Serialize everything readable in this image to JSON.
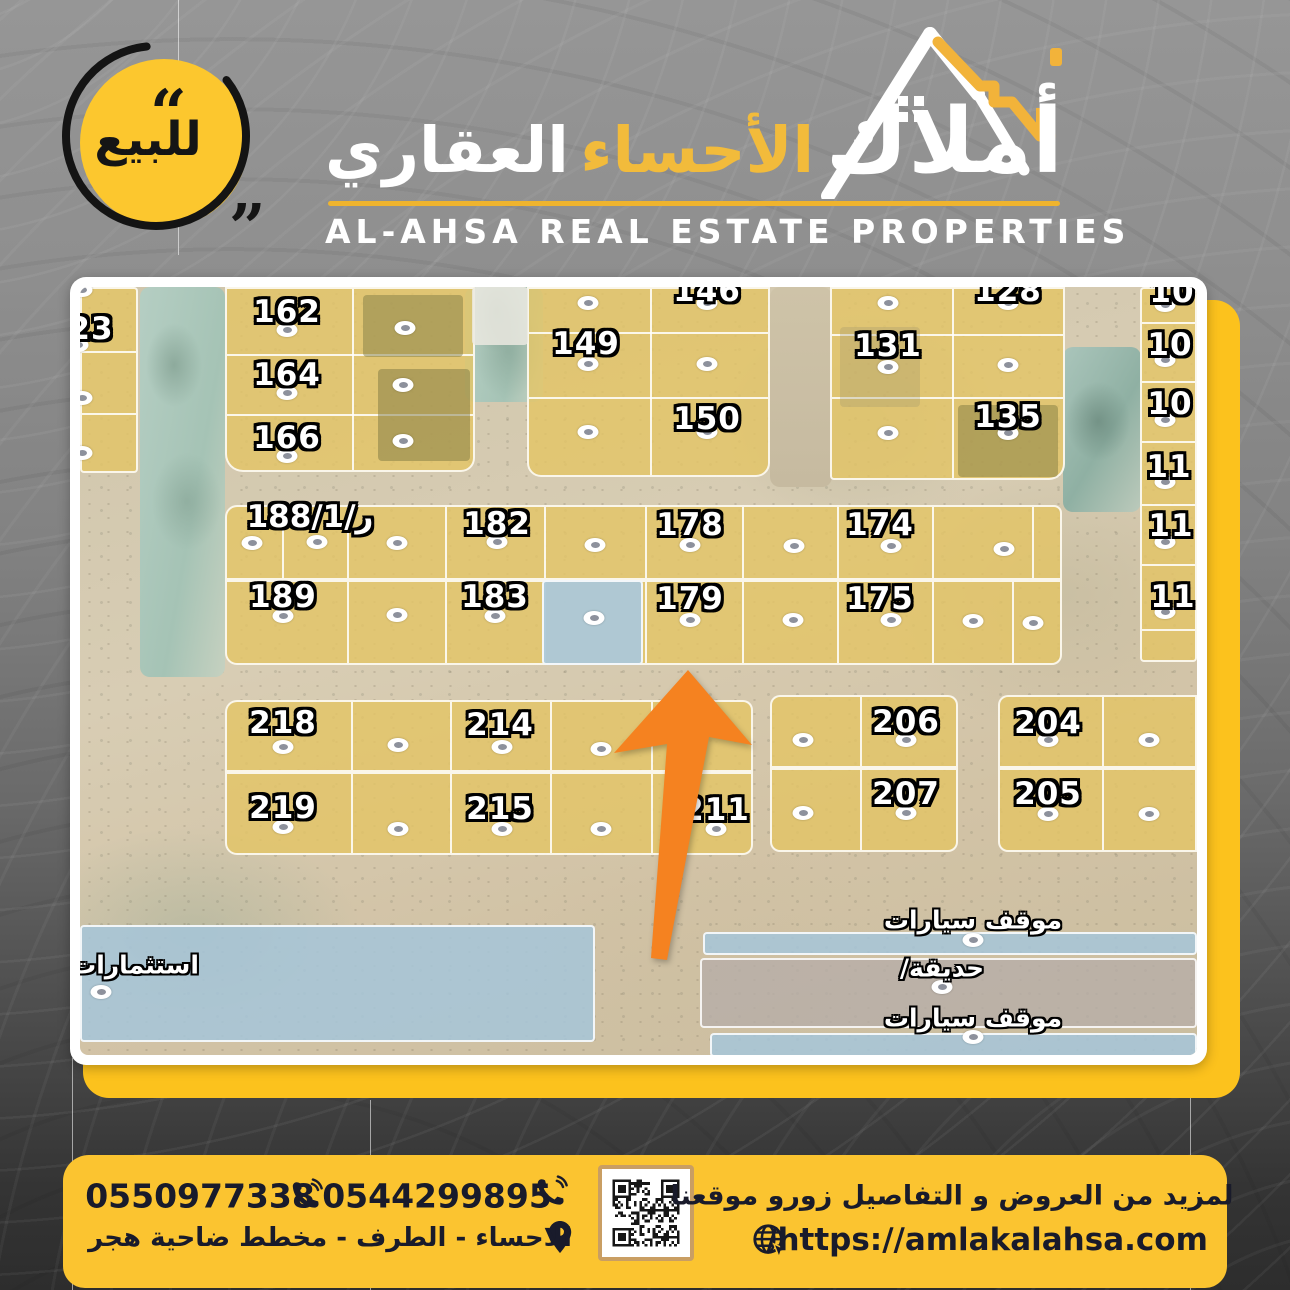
{
  "badge": {
    "label": "للبيع",
    "quote_open": "“",
    "quote_close": "„"
  },
  "logo": {
    "arabic_word_1": "أملاك",
    "arabic_word_2": "الأحساء",
    "arabic_word_3": "العقاري",
    "english": "AL-AHSA REAL ESTATE PROPERTIES"
  },
  "colors": {
    "accent_yellow": "#fcc21d",
    "footer_yellow": "#fbc430",
    "arrow_orange": "#f58220",
    "plot_yellow": "#e3c464",
    "water_blue": "#a6c6d9",
    "dark_text": "#191b2b"
  },
  "map": {
    "plots": [
      {
        "label": "23",
        "x": 11,
        "y": 42
      },
      {
        "label": "162",
        "x": 207,
        "y": 25
      },
      {
        "label": "164",
        "x": 207,
        "y": 88
      },
      {
        "label": "166",
        "x": 207,
        "y": 151
      },
      {
        "label": "146",
        "x": 627,
        "y": 4
      },
      {
        "label": "149",
        "x": 506,
        "y": 57
      },
      {
        "label": "150",
        "x": 627,
        "y": 132
      },
      {
        "label": "128",
        "x": 928,
        "y": 4
      },
      {
        "label": "131",
        "x": 808,
        "y": 59
      },
      {
        "label": "135",
        "x": 928,
        "y": 130
      },
      {
        "label": "10",
        "x": 1092,
        "y": 5
      },
      {
        "label": "10",
        "x": 1090,
        "y": 58
      },
      {
        "label": "10",
        "x": 1090,
        "y": 117
      },
      {
        "label": "11",
        "x": 1089,
        "y": 180
      },
      {
        "label": "11",
        "x": 1091,
        "y": 239
      },
      {
        "label": "11",
        "x": 1093,
        "y": 310
      },
      {
        "label": "ر/188/1",
        "x": 230,
        "y": 230
      },
      {
        "label": "182",
        "x": 417,
        "y": 237
      },
      {
        "label": "178",
        "x": 610,
        "y": 238
      },
      {
        "label": "174",
        "x": 800,
        "y": 238
      },
      {
        "label": "189",
        "x": 203,
        "y": 310
      },
      {
        "label": "183",
        "x": 415,
        "y": 310
      },
      {
        "label": "179",
        "x": 610,
        "y": 312
      },
      {
        "label": "175",
        "x": 800,
        "y": 312
      },
      {
        "label": "218",
        "x": 203,
        "y": 436
      },
      {
        "label": "214",
        "x": 420,
        "y": 438
      },
      {
        "label": "219",
        "x": 203,
        "y": 521
      },
      {
        "label": "215",
        "x": 420,
        "y": 522
      },
      {
        "label": "211",
        "x": 636,
        "y": 523
      },
      {
        "label": "206",
        "x": 826,
        "y": 435
      },
      {
        "label": "207",
        "x": 826,
        "y": 507
      },
      {
        "label": "204",
        "x": 968,
        "y": 436
      },
      {
        "label": "205",
        "x": 968,
        "y": 507
      }
    ],
    "area_labels": [
      {
        "label": "موقف سيارات",
        "x": 893,
        "y": 633
      },
      {
        "label": "حديقة/",
        "x": 862,
        "y": 681
      },
      {
        "label": "موقف سيارات",
        "x": 893,
        "y": 731
      },
      {
        "label": "استثمارات",
        "x": 55,
        "y": 678
      }
    ],
    "dots": [
      [
        2,
        3
      ],
      [
        -2,
        58
      ],
      [
        2,
        111
      ],
      [
        2,
        166
      ],
      [
        207,
        43
      ],
      [
        207,
        106
      ],
      [
        207,
        169
      ],
      [
        325,
        41
      ],
      [
        323,
        98
      ],
      [
        323,
        154
      ],
      [
        508,
        16
      ],
      [
        627,
        16
      ],
      [
        508,
        77
      ],
      [
        627,
        77
      ],
      [
        508,
        145
      ],
      [
        627,
        145
      ],
      [
        808,
        16
      ],
      [
        928,
        16
      ],
      [
        808,
        80
      ],
      [
        928,
        78
      ],
      [
        808,
        146
      ],
      [
        928,
        146
      ],
      [
        1085,
        18
      ],
      [
        1085,
        73
      ],
      [
        1085,
        133
      ],
      [
        1085,
        195
      ],
      [
        1085,
        255
      ],
      [
        1085,
        325
      ],
      [
        172,
        256
      ],
      [
        237,
        255
      ],
      [
        317,
        256
      ],
      [
        417,
        255
      ],
      [
        515,
        258
      ],
      [
        610,
        258
      ],
      [
        714,
        259
      ],
      [
        811,
        259
      ],
      [
        924,
        262
      ],
      [
        203,
        329
      ],
      [
        317,
        328
      ],
      [
        415,
        329
      ],
      [
        514,
        331
      ],
      [
        610,
        333
      ],
      [
        713,
        333
      ],
      [
        811,
        333
      ],
      [
        893,
        334
      ],
      [
        953,
        336
      ],
      [
        203,
        460
      ],
      [
        318,
        458
      ],
      [
        422,
        460
      ],
      [
        521,
        462
      ],
      [
        203,
        540
      ],
      [
        318,
        542
      ],
      [
        422,
        542
      ],
      [
        521,
        542
      ],
      [
        636,
        542
      ],
      [
        723,
        453
      ],
      [
        826,
        453
      ],
      [
        723,
        526
      ],
      [
        826,
        526
      ],
      [
        968,
        453
      ],
      [
        1069,
        453
      ],
      [
        968,
        527
      ],
      [
        1069,
        527
      ],
      [
        893,
        653
      ],
      [
        862,
        700
      ],
      [
        893,
        750
      ],
      [
        21,
        705
      ]
    ],
    "roads": [
      {
        "x": 60,
        "y": 0,
        "w": 85,
        "h": 390,
        "c": "teal"
      },
      {
        "x": 385,
        "y": 0,
        "w": 78,
        "h": 115,
        "c": "teal"
      },
      {
        "x": 983,
        "y": 60,
        "w": 78,
        "h": 165,
        "c": "teal2"
      },
      {
        "x": 690,
        "y": 0,
        "w": 62,
        "h": 200,
        "c": "sand2"
      }
    ],
    "blocks": [
      {
        "x": 0,
        "y": 0,
        "w": 58,
        "h": 186,
        "hd": [
          62,
          124
        ]
      },
      {
        "x": 145,
        "y": 0,
        "w": 250,
        "h": 185,
        "vd": [
          125
        ],
        "hd": [
          65,
          125
        ],
        "r": "0 0 14px 18px"
      },
      {
        "x": 447,
        "y": 0,
        "w": 243,
        "h": 190,
        "vd": [
          121
        ],
        "hd": [
          43,
          108
        ],
        "r": "0 0 14px 14px"
      },
      {
        "x": 750,
        "y": 0,
        "w": 235,
        "h": 193,
        "vd": [
          120
        ],
        "hd": [
          45,
          108
        ],
        "r": "0 0 16px 4px"
      },
      {
        "x": 1060,
        "y": 0,
        "w": 57,
        "h": 375,
        "hd": [
          33,
          92,
          152,
          215,
          275,
          340
        ]
      },
      {
        "x": 145,
        "y": 218,
        "w": 837,
        "h": 75,
        "vd": [
          55,
          120,
          218,
          317,
          418,
          515,
          610,
          705,
          805
        ],
        "r": "12px 8px 0 0"
      },
      {
        "x": 145,
        "y": 293,
        "w": 837,
        "h": 85,
        "vd": [
          120,
          218,
          317,
          418,
          515,
          610,
          705,
          785
        ],
        "r": "0 0 10px 12px"
      },
      {
        "x": 145,
        "y": 413,
        "w": 528,
        "h": 72,
        "vd": [
          124,
          223,
          323,
          424
        ],
        "r": "12px 10px 0 0"
      },
      {
        "x": 145,
        "y": 485,
        "w": 528,
        "h": 83,
        "vd": [
          124,
          223,
          323,
          424
        ],
        "r": "0 0 10px 12px"
      },
      {
        "x": 690,
        "y": 408,
        "w": 188,
        "h": 73,
        "vd": [
          88
        ],
        "r": "10px 10px 0 0"
      },
      {
        "x": 690,
        "y": 481,
        "w": 188,
        "h": 84,
        "vd": [
          88
        ],
        "r": "0 0 10px 10px"
      },
      {
        "x": 918,
        "y": 408,
        "w": 199,
        "h": 73,
        "vd": [
          102
        ],
        "r": "10px 0 0 0"
      },
      {
        "x": 918,
        "y": 481,
        "w": 199,
        "h": 84,
        "vd": [
          102
        ],
        "r": "0 0 0 10px"
      },
      {
        "x": 462,
        "y": 293,
        "w": 101,
        "h": 85,
        "f": "blue2"
      },
      {
        "x": 0,
        "y": 638,
        "w": 515,
        "h": 117,
        "f": "blue"
      },
      {
        "x": 623,
        "y": 645,
        "w": 494,
        "h": 23,
        "f": "blue"
      },
      {
        "x": 620,
        "y": 671,
        "w": 497,
        "h": 70,
        "f": "gray"
      },
      {
        "x": 630,
        "y": 746,
        "w": 487,
        "h": 24,
        "f": "blue"
      }
    ],
    "buildings": [
      {
        "x": 283,
        "y": 8,
        "w": 100,
        "h": 62,
        "c": "rgba(130,125,70,0.5)"
      },
      {
        "x": 298,
        "y": 82,
        "w": 92,
        "h": 92,
        "c": "rgba(125,120,65,0.5)"
      },
      {
        "x": 878,
        "y": 118,
        "w": 100,
        "h": 72,
        "c": "rgba(120,115,60,0.45)"
      },
      {
        "x": 392,
        "y": 0,
        "w": 56,
        "h": 58,
        "c": "rgba(235,233,224,0.85)"
      },
      {
        "x": 760,
        "y": 40,
        "w": 80,
        "h": 80,
        "c": "rgba(160,150,110,0.3)"
      }
    ]
  },
  "footer": {
    "phone_1": "0550977338",
    "phone_2": "0544299895",
    "address": "الاحساء - الطرف - مخطط ضاحية هجر",
    "promo": "لمزيد من العروض و التفاصيل زورو موقعنا",
    "website": "/https://amlakalahsa.com"
  }
}
